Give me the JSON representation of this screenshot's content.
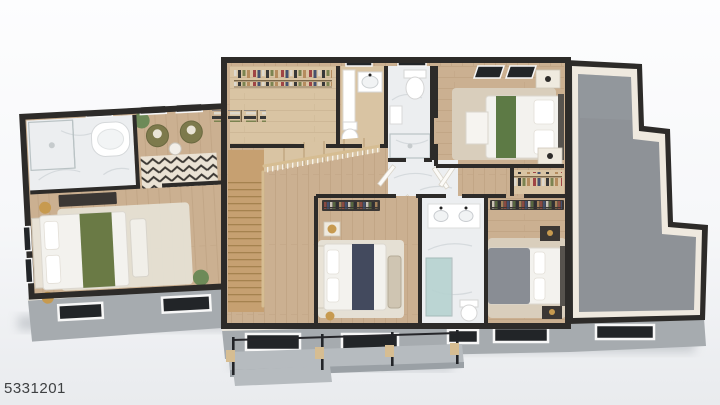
{
  "meta": {
    "photo_label": "5331201"
  },
  "scene": {
    "type": "3d-floorplan-dollhouse-render",
    "rooms": [
      "primary-bathroom",
      "primary-sitting-area",
      "primary-bedroom",
      "walk-in-closet",
      "hall-bathroom-a",
      "hall-bathroom-b",
      "bedroom-top-right",
      "hallway",
      "staircase",
      "bedroom-bottom-middle",
      "shared-bathroom",
      "bedroom-bottom-right",
      "unfinished-storage",
      "exterior-deck"
    ]
  },
  "colors": {
    "wall": "#2d2b29",
    "wall_inner": "#efe9df",
    "wood": "#cbb091",
    "wood_light": "#d9c4a3",
    "wood_stairs": "#c6a071",
    "marble": "#eceef0",
    "gray_floor": "#8e9297",
    "fascia": "#a6abaf",
    "deck": "#b6bbbf",
    "deck_face": "#9aa0a5",
    "glass": "#222528",
    "frame": "#f7f7f7",
    "green_primary": "#6a7a45",
    "green_throw": "#5d7a45",
    "olive": "#7d7a4c",
    "navy": "#434a5e",
    "gray_duvet": "#898d94",
    "bed_white": "#f3f2ee",
    "rug": "#e5e0d4",
    "rug2": "#d9cebc",
    "gold": "#c79a4f",
    "plant": "#6d8a58",
    "furn_dark": "#3b3734",
    "teal": "#b7d3d1",
    "rail_wood": "#d6bd92",
    "headboard": "#57534e",
    "shadow": "#a9aeb4",
    "label": "#3e4042"
  }
}
